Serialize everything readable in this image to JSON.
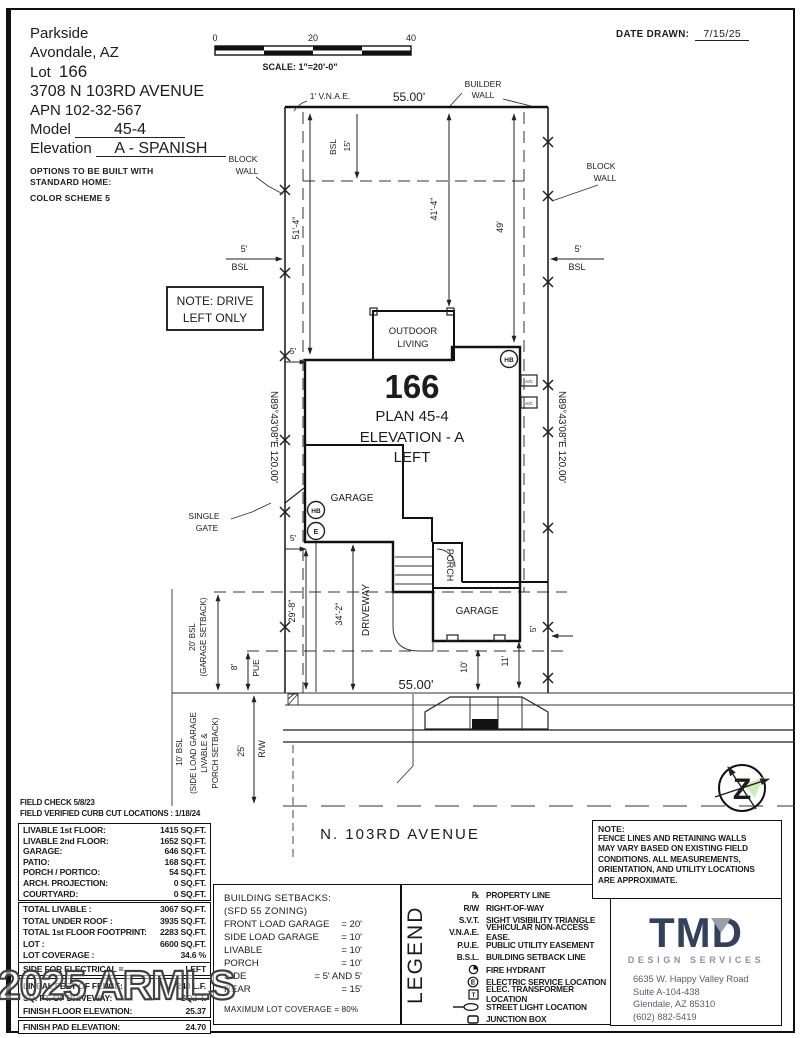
{
  "header": {
    "community": "Parkside",
    "city": "Avondale, AZ",
    "lot_label": "Lot",
    "lot_number": "166",
    "address": "3708 N 103RD AVENUE",
    "apn": "APN 102-32-567",
    "model_label": "Model",
    "model_value": "45-4",
    "elevation_label": "Elevation",
    "elevation_value": "A - SPANISH",
    "options_line1": "OPTIONS TO BE BUILT WITH",
    "options_line2": "STANDARD HOME:",
    "options_line3": "COLOR SCHEME 5",
    "date_drawn_label": "DATE DRAWN:",
    "date_drawn_value": "7/15/25",
    "scale": {
      "t0": "0",
      "t20": "20",
      "t40": "40",
      "label": "SCALE: 1\"=20'-0\""
    }
  },
  "plan": {
    "vnae": "1' V.N.A.E.",
    "lot_width_top": "55.00'",
    "builder_wall_1": "BUILDER",
    "builder_wall_2": "WALL",
    "block_wall_1": "BLOCK",
    "block_wall_2": "WALL",
    "bsl": "BSL",
    "dim_15": "15'",
    "dim_5": "5'",
    "dim_41_4": "41'-4\"",
    "dim_49": "49'",
    "dim_51_4": "51'-4\"",
    "note_drive_1": "NOTE: DRIVE",
    "note_drive_2": "LEFT ONLY",
    "bearing": "N89°43'08\"E 120.00'",
    "lot_number": "166",
    "plan_name": "PLAN 45-4",
    "elevation_name": "ELEVATION - A",
    "elevation_side": "LEFT",
    "outdoor_1": "OUTDOOR",
    "outdoor_2": "LIVING",
    "garage": "GARAGE",
    "porch": "PORCH",
    "driveway": "DRIVEWAY",
    "single_1": "SINGLE",
    "single_2": "GATE",
    "hb": "HB",
    "e": "E",
    "ac": "A/C",
    "dim_29_8": "29'-8\"",
    "dim_34_2": "34'-2\"",
    "lot_width_bottom": "55.00'",
    "dim_10": "10'",
    "dim_11": "11'",
    "setback20_1": "20' BSL",
    "setback20_2": "(GARAGE SETBACK)",
    "dim_8": "8'",
    "pue": "PUE",
    "bsl10_1": "10' BSL",
    "bsl10_2": "(SIDE LOAD GARAGE",
    "bsl10_3": "LIVABLE &",
    "bsl10_4": "PORCH SETBACK)",
    "dim_25": "25'",
    "rw": "R/W",
    "street": "N. 103RD AVENUE",
    "compass_letter": "Z"
  },
  "tables": {
    "field_note_1": "FIELD CHECK 5/8/23",
    "field_note_2": "FIELD VERIFIED CURB CUT LOCATIONS : 1/18/24",
    "area": [
      {
        "label": "LIVABLE 1st FLOOR:",
        "value": "1415 SQ.FT."
      },
      {
        "label": "LIVABLE 2nd FLOOR:",
        "value": "1652 SQ.FT."
      },
      {
        "label": "GARAGE:",
        "value": "646 SQ.FT."
      },
      {
        "label": "PATIO:",
        "value": "168 SQ.FT."
      },
      {
        "label": "PORCH / PORTICO:",
        "value": "54 SQ.FT."
      },
      {
        "label": "ARCH. PROJECTION:",
        "value": "0 SQ.FT."
      },
      {
        "label": "COURTYARD:",
        "value": "0 SQ.FT."
      }
    ],
    "totals": [
      {
        "label": "TOTAL LIVABLE :",
        "value": "3067 SQ.FT."
      },
      {
        "label": "TOTAL UNDER ROOF :",
        "value": "3935 SQ.FT."
      },
      {
        "label": "TOTAL 1st FLOOR FOOTPRINT:",
        "value": "2283 SQ.FT."
      },
      {
        "label": "LOT :",
        "value": "6600 SQ.FT."
      },
      {
        "label": "LOT COVERAGE :",
        "value": "34.6 %"
      }
    ],
    "electrical": {
      "label": "SIDE FOR ELECTRICAL =",
      "value": "LEFT"
    },
    "misc": [
      {
        "label": "LINEAL FEET OF FENCE:",
        "value": "240 L.F."
      },
      {
        "label": "SQ. FT. OF DRIVEWAY:",
        "value": "SQ.FT."
      },
      {
        "label": "FINISH FLOOR ELEVATION:",
        "value": "25.37"
      }
    ],
    "pad": {
      "label": "FINISH PAD ELEVATION:",
      "value": "24.70"
    }
  },
  "setbacks": {
    "title": "BUILDING SETBACKS:",
    "subtitle": "(SFD 55 ZONING)",
    "rows": [
      {
        "label": "FRONT LOAD GARAGE",
        "value": "= 20'"
      },
      {
        "label": "SIDE LOAD GARAGE",
        "value": "= 10'"
      },
      {
        "label": "LIVABLE",
        "value": "= 10'"
      },
      {
        "label": "PORCH",
        "value": "= 10'"
      },
      {
        "label": "SIDE",
        "value": "= 5' AND 5'"
      },
      {
        "label": "REAR",
        "value": "= 15'"
      }
    ],
    "max": "MAXIMUM LOT COVERAGE = 80%"
  },
  "legend": {
    "title": "LEGEND",
    "icon_e": "E",
    "icon_t": "T",
    "items": [
      {
        "sym": "℞",
        "label": "PROPERTY LINE"
      },
      {
        "sym": "R/W",
        "label": "RIGHT-OF-WAY"
      },
      {
        "sym": "S.V.T.",
        "label": "SIGHT VISIBILITY TRIANGLE"
      },
      {
        "sym": "V.N.A.E.",
        "label": "VEHICULAR NON-ACCESS EASE."
      },
      {
        "sym": "P.U.E.",
        "label": "PUBLIC UTILITY EASEMENT"
      },
      {
        "sym": "B.S.L.",
        "label": "BUILDING SETBACK LINE"
      },
      {
        "sym": "",
        "label": "FIRE HYDRANT"
      },
      {
        "sym": "",
        "label": "ELECTRIC SERVICE LOCATION"
      },
      {
        "sym": "",
        "label": "ELEC. TRANSFORMER LOCATION"
      },
      {
        "sym": "",
        "label": "STREET LIGHT LOCATION"
      },
      {
        "sym": "",
        "label": "JUNCTION BOX"
      }
    ]
  },
  "note": {
    "title": "NOTE:",
    "lines": [
      "FENCE LINES AND RETAINING WALLS",
      "MAY VARY BASED ON EXISTING FIELD",
      "CONDITIONS.  ALL MEASUREMENTS,",
      "ORIENTATION, AND UTILITY LOCATIONS",
      "ARE APPROXIMATE."
    ]
  },
  "firm": {
    "logo": "TMD",
    "tagline": "DESIGN SERVICES",
    "addr1": "6635 W. Happy Valley Road",
    "addr2": "Suite A-104-438",
    "addr3": "Glendale, AZ 85310",
    "addr4": "(602) 882-5419"
  },
  "watermark": "2025 ARMLS"
}
